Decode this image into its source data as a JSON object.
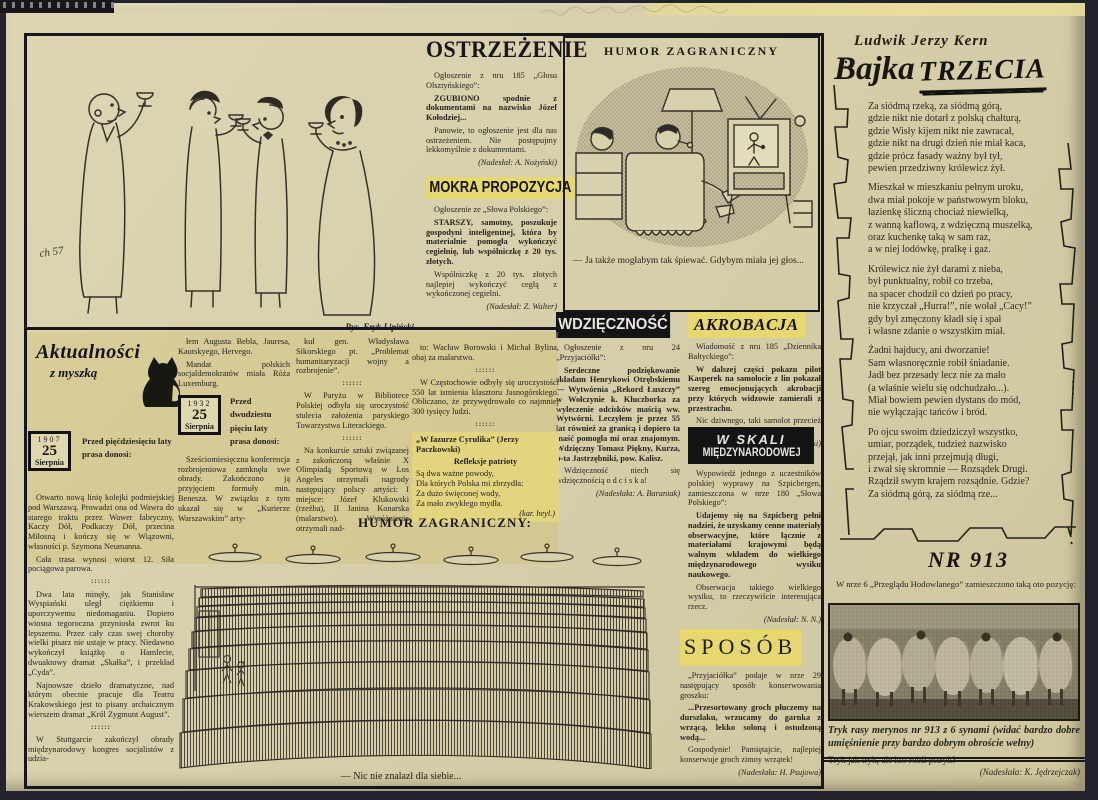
{
  "party": {
    "sig": "ch 57",
    "credit": "Rys. Eryk Lipiński"
  },
  "ostrzezenie": {
    "title": "OSTRZEŻENIE",
    "src": "Ogłoszenie z nru 185 „Głosu Olsztyńskiego”:",
    "quote": "ZGUBIONO spodnie z dokumentami na nazwisko Józef Kołodziej...",
    "comment": "Panowie, to ogłoszenie jest dla nas ostrzeżeniem. Nie postępujmy lekkomyślnie z dokumentami.",
    "credit": "(Nadesłał: A. Nożyński)"
  },
  "mokra": {
    "title": "MOKRA PROPOZYCJA",
    "src": "Ogłoszenie ze „Słowa Polskiego”:",
    "quote": "STARSZY, samotny, poszukuje gospodyni inteligentnej, która by materialnie pomogła wykończyć cegielnię, lub wspólniczkę z 20 tys. złotych.",
    "comment": "Wspólniczkę z 20 tys. złotych najlepiej wykończyć cegłą z wykończonej cegielni.",
    "credit": "(Nadesłał: Z. Walter)"
  },
  "humor_tv": {
    "title": "HUMOR ZAGRANICZNY",
    "caption": "— Ja także mogłabym tak śpiewać. Gdybym miała jej głos..."
  },
  "wdziecznosc": {
    "title": "WDZIĘCZNOŚĆ",
    "src": "Ogłoszenie z nru 24 „Przyjaciółki”:",
    "quote": "Serdeczne podziękowanie składam Henrykowi Otrębskiemu — Wytwórnia „Rekord Łuszczy” w Wołczynie k. Kluczborka za wyleczenie odcisków maścią ww. Wytwórni. Leczyłem je przez 55 lat również za granicą i dopiero ta maść pomogła mi oraz znajomym. Wdzięczny Tomasz Piękny, Kurza, p-ta Jastrzębniki, pow. Kalisz.",
    "punch": "Wdzięczność niech się wdzięcznością o d c i s k a!",
    "credit": "(Nadesłała: A. Baraniak)"
  },
  "akrobacja": {
    "title": "AKROBACJA",
    "src": "Wiadomość z nru 185 „Dziennika Bałtyckiego”:",
    "quote": "W dalszej części pokazu pilot Kasperek na samolocie z lin pokazał szereg emocjonujących akrobacji przy których widzowie zamierali z przestrachu.",
    "comment": "Nic dziwnego, taki samolot przecież nie może być zbyt szczelny...",
    "credit": "(Nadesłał: S. Grębski)"
  },
  "w_skali": {
    "title1": "W SKALI",
    "title2": "MIĘDZYNARODOWEJ",
    "src": "Wypowiedź jednego z uczestników polskiej wyprawy na Szpicbergen, zamieszczona w nrze 180 „Słowa Polskiego”:",
    "quote": "Udajemy się na Szpicberg pełni nadziei, że uzyskamy cenne materiały obserwacyjne, które łącznie z materiałami krajowymi będą walnym wkładem do wielkiego międzynarodowego wysiku naukowego.",
    "comment": "Obserwacja takiego wielkiego wysiku, to rzeczywiście interesująca rzecz.",
    "credit": "(Nadesłał: N. N.)"
  },
  "sposob": {
    "title": "SPOSÓB",
    "src": "„Przyjaciółka” podaje w nrze 29 następujący sposób konserwowania groszku:",
    "quote": "...Przesortowany groch płuczemy na durszlaku, wrzucamy do garnka z wrzącą, lekko soloną i ostudzoną wodą...",
    "comment": "Gospodynie! Pamiętajcie, najlepiej konserwuje groch zimny wrzątek!",
    "credit": "(Nadesłała: H. Psujowa)"
  },
  "aktualnosci": {
    "logo": "Aktualności",
    "logo2": "z myszką",
    "badge1": {
      "year": "1907",
      "day": "25",
      "month": "Sierpnia"
    },
    "lead1": "Przed pięćdziesięciu laty prasa donosi:",
    "badge2": {
      "year": "1932",
      "day": "25",
      "month": "Sierpnia"
    },
    "lead2": "Przed dwudziestu pięciu laty prasa donosi:",
    "col1": [
      "Otwarto nową linię kolejki podmiejskiej pod Warszawą. Prowadzi ona od Wawra do starego traktu przez Wawer fabryczny, Kaczy Dół, Podkaczy Dół, przecina Miłosną i kończy się w Wiązowni, własności p. Szymona Neumanna.",
      "Cała trasa wynosi wiorst 12. Siła pociągowa parowa.",
      "::::::",
      "Dwa lata minęły, jak Stanisław Wyspiański uległ ciężkiemu i uporczywemu niedomaganiu. Dopiero wiosna tegoroczna przyniosła zwrot ku lepszemu. Przez cały czas swej choroby wielki pisarz nie ustaje w pracy. Niedawno wykończył książkę o Hamlecie, dwuaktowy dramat „Skałka”, i przekład „Cyda”.",
      "Najnowsze dzieło dramatyczne, nad którym obecnie pracuje dla Teatru Krakowskiego jest to pisany archaicznym wierszem dramat „Król Zygmunt August”.",
      "::::::",
      "W Stuttgarcie zakończył obrady międzynarodowy kongres socjalistów z udzia-"
    ],
    "col2a": [
      "łem Augusta Bebla, Jauresa, Kautskyego, Hervego.",
      "Mandat polskich socjaldemokratów miała Róża Luxemburg."
    ],
    "col2b": [
      "Sześciomiesięczna konferencja rozbrojeniowa zamknęła swe obrady. Zakończono ją przyjęciem formuły min. Benesza. W związku z tym ukazał się w „Kurierze Warszawskim” arty-"
    ],
    "col3": [
      "kuł gen. Władysława Sikorskiego pt. „Problemat humanitaryzacji wojny a rozbrojenie”.",
      "::::::",
      "W Paryżu w Bibliotece Polskiej odbyła się uroczystość stulecia założenia paryskiego Towarzystwa Literackiego.",
      "::::::",
      "Na konkursie sztuki związanej z zakończoną właśnie X Olimpiadą Sportową w Los Angeles otrzymali nagrody następujący polscy artyści: I miejsce: Józef Klukowski (rzeźba), II Janina Konarska (malarstwo). Wyróżnienia otrzymali nad-"
    ],
    "col4": [
      "to: Wacław Borowski i Michał Bylina, obaj za malarstwo.",
      "::::::",
      "W Częstochowie odbyły się uroczystości 550 lat istnienia klasztoru Jasnogórskiego. Obliczano, że przywędrowało co najmniej 300 tysięcy ludzi.",
      "::::::"
    ],
    "quote_block": {
      "t1": "„W fazurze Cyrulika” (Jerzy Paczkowski)",
      "t2": "Refleksje patrioty",
      "lines": [
        "Są dwa ważne powody,",
        "Dla których Polska mi zbrzydła:",
        "Za dużo święconej wody,",
        "Za mało zwykłego mydła.",
        "(kar. beyl.)"
      ]
    }
  },
  "humor_theater": {
    "title": "HUMOR ZAGRANICZNY:",
    "caption": "— Nic nie znalazł dla siebie..."
  },
  "bajka": {
    "author": "Ludwik Jerzy Kern",
    "title_a": "Bajka",
    "title_b": "TRZECIA",
    "stanzas": [
      [
        "Za siódmą rzeką, za siódmą górą,",
        "gdzie nikt nie dotarł z polską chałturą,",
        "gdzie Wisły kijem nikt nie zawracał,",
        "gdzie nikt na drugi dzień nie miał kaca,",
        "gdzie prócz fasady ważny był tył,",
        "pewien przedziwny królewicz żył."
      ],
      [
        "Mieszkał w mieszkaniu pełnym uroku,",
        "dwa miał pokoje w państwowym bloku,",
        "łazienkę śliczną chociaż niewielką,",
        "z wanną kaflową, z wdzięczną muszelką,",
        "oraz kuchenkę taką w sam raz,",
        "a w niej lodówkę, pralkę i gaz."
      ],
      [
        "Królewicz nie żył darami z nieba,",
        "był punktualny, robił co trzeba,",
        "na spacer chodził co dzień po pracy,",
        "nie krzyczał „Hurra!”, nie wołał „Cacy!”",
        "gdy był zmęczony kładł się i spał",
        "i własne zdanie o wszystkim miał."
      ],
      [
        "Żadni hajducy, ani dworzanie!",
        "Sam własnoręcznie robił śniadanie.",
        "Jadł bez przesady lecz nie za mało",
        "(a właśnie wielu się odchudzało...).",
        "Miał bowiem pewien dystans do mód,",
        "nie wyłączając tańców i bród."
      ],
      [
        "Po ojcu swoim dziedziczył wszystko,",
        "umiar, porządek, tudzież nazwisko",
        "przejął, jak inni przejmują długi,",
        "i zwał się skromnie — Rozsądek Drugi.",
        "Rządził swym krajem rozsądnie. Gdzie?",
        "Za siódmą górą, za siódmą rze..."
      ]
    ]
  },
  "nr913": {
    "title": "NR 913",
    "intro": "W nrze 6 „Przeglądu Hodowlanego” zamieszczono taką oto pozycję:",
    "photo_caption": "Tryk rasy merynos nr 913 z 6 synami (widać bardzo dobre umięśnienie przy bardzo dobrym obroście wełny)",
    "line": "Tryk jak tryk, ale kto robił pstryk?",
    "credit": "(Nadesłała: K. Jędrzejczak)"
  }
}
